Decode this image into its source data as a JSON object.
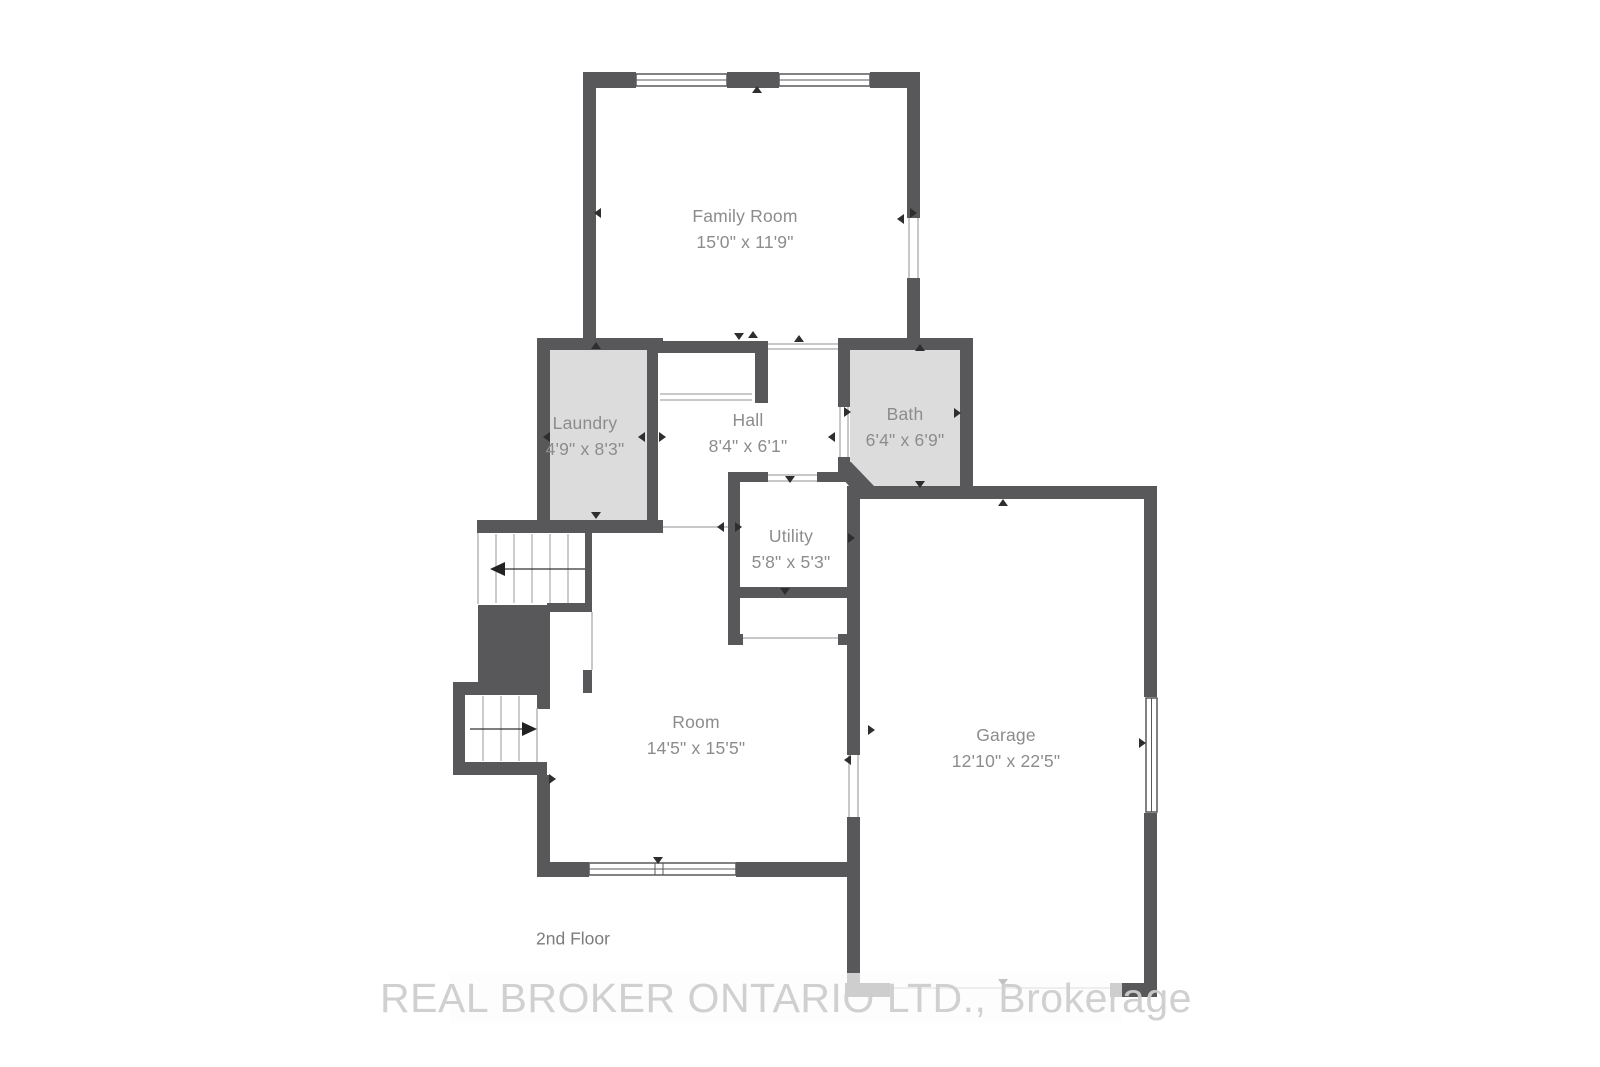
{
  "plan": {
    "floor_label": "2nd Floor",
    "watermark": "REAL BROKER ONTARIO LTD., Brokerage",
    "colors": {
      "wall": "#58585a",
      "room_fill": "#dcdcdc",
      "label_text": "#8c8c8c",
      "tick": "#2e2e2e",
      "watermark_text": "#cdcdcd"
    },
    "rooms": [
      {
        "key": "family-room",
        "name": "Family Room",
        "dims": "15'0\" x 11'9\""
      },
      {
        "key": "laundry",
        "name": "Laundry",
        "dims": "4'9\" x 8'3\""
      },
      {
        "key": "hall",
        "name": "Hall",
        "dims": "8'4\" x 6'1\""
      },
      {
        "key": "bath",
        "name": "Bath",
        "dims": "6'4\" x 6'9\""
      },
      {
        "key": "utility",
        "name": "Utility",
        "dims": "5'8\" x 5'3\""
      },
      {
        "key": "room",
        "name": "Room",
        "dims": "14'5\" x 15'5\""
      },
      {
        "key": "garage",
        "name": "Garage",
        "dims": "12'10\" x 22'5\""
      }
    ]
  }
}
